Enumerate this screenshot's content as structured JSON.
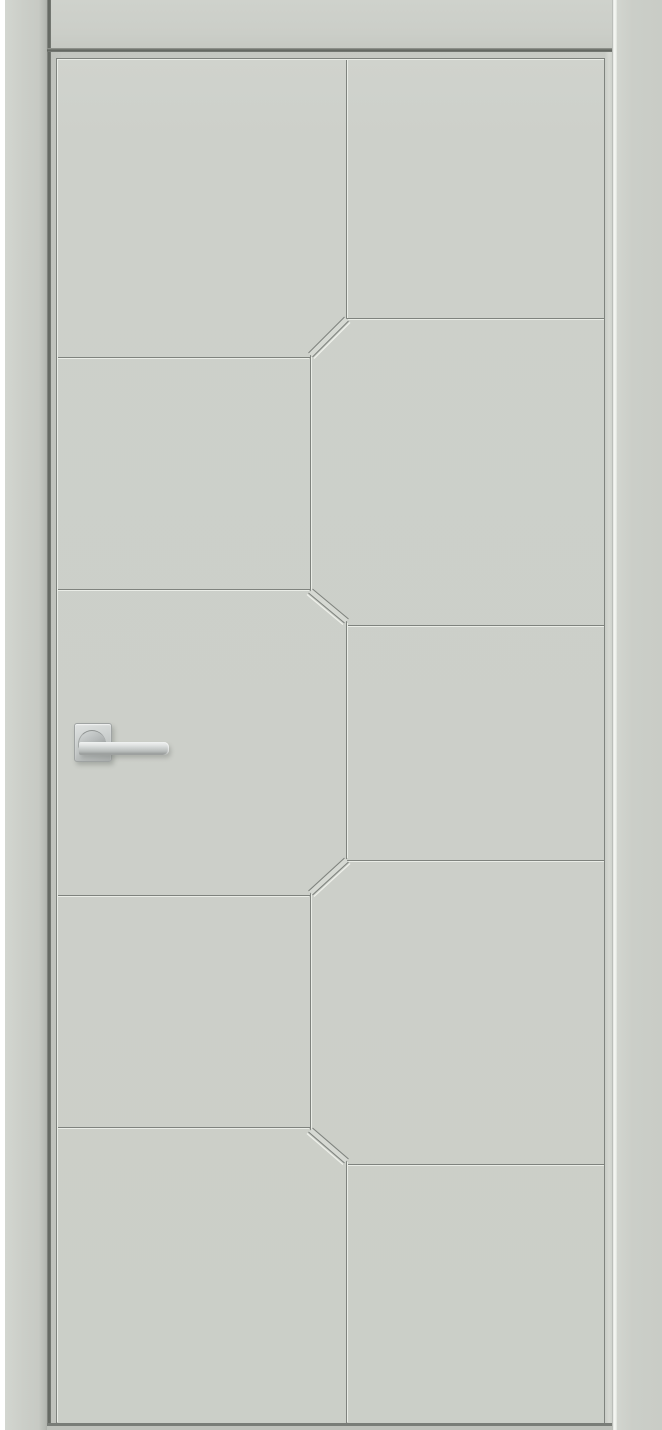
{
  "image": {
    "kind": "product photo",
    "subject": "Closed light-grey interior door shown in its frame",
    "alt": "Light grey enamel interior door with a milled geometric groove pattern: two staggered columns of panels joined by short diagonal chamfer grooves along a zig-zag centre line, and a satin-chrome lever handle on a square rosette on the left side"
  },
  "colors": {
    "bg": "#ffffff",
    "casing": "#cbcec8",
    "leaf": "#cdd0ca",
    "leaf-edge": "#c3c6c0",
    "leaf-edge-right": "#d6d9d3",
    "joint": "#f5f7f3",
    "groove-dark": "#7f837e",
    "groove-light": "#eaede7",
    "chamfer-fill": "#d6d9d3",
    "bottom-edge": "#797d78",
    "handle-base": "#c2c6c5",
    "handle-light": "#f0f2f1",
    "handle-dark": "#8d908f"
  },
  "door": {
    "frame_label": "door frame casing",
    "leaf_label": "door leaf",
    "handle_label": "satin chrome lever handle on square rosette",
    "pattern": {
      "style": "staggered rectangular and chamfer-cornered panels",
      "left_column_divider_grooves_y": [
        357,
        589,
        895,
        1127
      ],
      "right_column_divider_grooves_y": [
        318,
        625,
        860,
        1164
      ],
      "centre_groove_x_positions": [
        346,
        310
      ],
      "diagonal_chamfer_count": 4
    }
  }
}
